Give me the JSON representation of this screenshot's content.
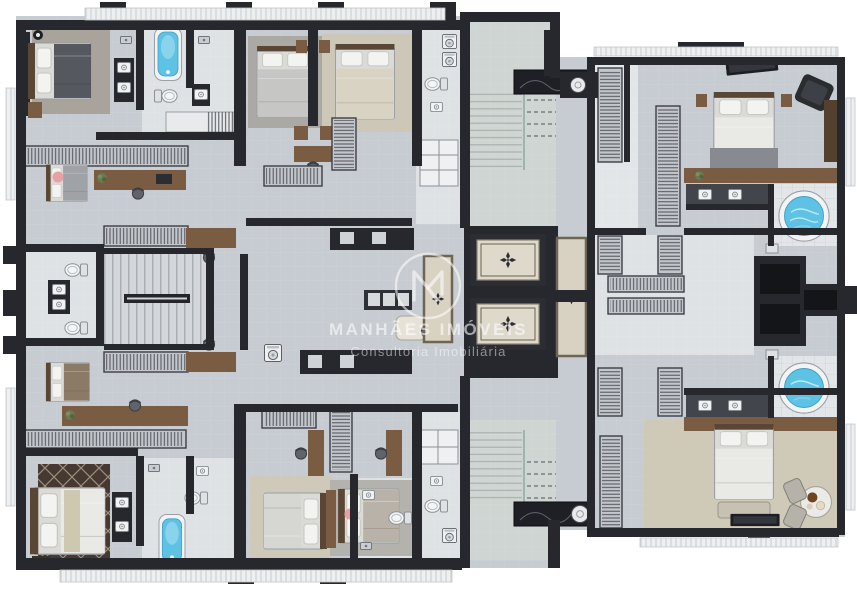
{
  "watermark": {
    "brand": "MANHÃES IMÓVEIS",
    "tagline": "Consultoria Imobiliária",
    "logo": "circled M monogram"
  },
  "colors": {
    "page_bg": "#ffffff",
    "floor": "#c7ccd2",
    "floor_light": "#dfe2e5",
    "stair_floor": "#ced5d2",
    "tile": "#e3e6e8",
    "wall": "#26282d",
    "wall_soft": "#42464c",
    "wood": "#7a5c42",
    "wood_dark": "#54402e",
    "porcelain": "#f2f3f4",
    "water": "#5ec2e4",
    "carpet": "#cfc9b8",
    "rug_gray": "#a8a39b",
    "rug_dark": "#453931",
    "bed_white": "#e9e9e6",
    "blanket_dark": "#55585e",
    "marble": "#1e2025",
    "balcony": "#edeff1",
    "glass": "#9fb4ae",
    "accent_pink": "#e8a0a4",
    "plant": "#6a7a55",
    "watermark": "rgba(255,255,255,0.58)",
    "watermark_soft": "rgba(255,255,255,0.48)"
  },
  "plan_elements": {
    "beds": 10,
    "bathtubs": 2,
    "jacuzzis": 2,
    "elevators": 2,
    "staircases": 3,
    "toilets": 7,
    "washbasins": 12,
    "washing_machines": 2,
    "closet_racks": 16,
    "desks": 6,
    "tvs": 2,
    "armchairs": 1,
    "dining_tables": 2,
    "plants": 3
  },
  "icons": [
    "bed",
    "bathtub",
    "jacuzzi",
    "elevator",
    "staircase",
    "toilet",
    "washbasin",
    "washing-machine",
    "closet-rack",
    "desk-chair",
    "tv",
    "round-table",
    "armchair",
    "plant",
    "marble-counter",
    "rug"
  ]
}
